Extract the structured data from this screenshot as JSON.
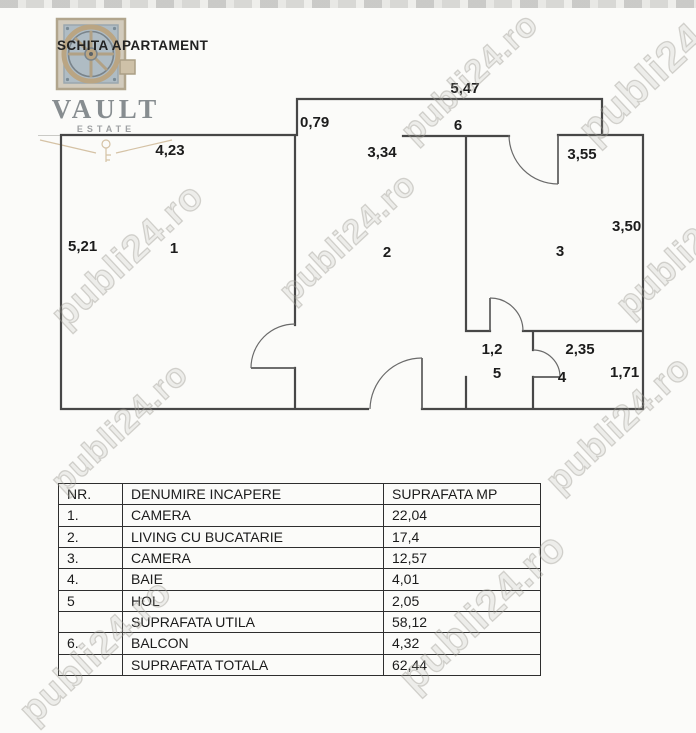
{
  "title": "SCHITA APARTAMENT",
  "logo": {
    "name": "VAULT",
    "tagline": "ESTATE"
  },
  "watermark": {
    "text": "publi24.ro"
  },
  "plan": {
    "rooms": {
      "r1": "1",
      "r2": "2",
      "r3": "3",
      "r4": "4",
      "r5": "5",
      "r6": "6"
    },
    "dims": {
      "d547": "5,47",
      "d079": "0,79",
      "d423": "4,23",
      "d334": "3,34",
      "d355": "3,55",
      "d350": "3,50",
      "d521": "5,21",
      "d12": "1,2",
      "d235": "2,35",
      "d171": "1,71"
    }
  },
  "table": {
    "columns": [
      "NR.",
      "DENUMIRE INCAPERE",
      "SUPRAFATA MP"
    ],
    "rows": [
      {
        "nr": "1.",
        "name": "CAMERA",
        "area": "22,04"
      },
      {
        "nr": "2.",
        "name": "LIVING CU BUCATARIE",
        "area": "17,4"
      },
      {
        "nr": "3.",
        "name": "CAMERA",
        "area": "12,57"
      },
      {
        "nr": "4.",
        "name": "BAIE",
        "area": "4,01"
      },
      {
        "nr": "5",
        "name": "HOL",
        "area": "2,05"
      },
      {
        "nr": "",
        "name": "SUPRAFATA UTILA",
        "area": "58,12"
      },
      {
        "nr": "6.",
        "name": "BALCON",
        "area": "4,32"
      },
      {
        "nr": "",
        "name": "SUPRAFATA TOTALA",
        "area": "62,44"
      }
    ]
  }
}
